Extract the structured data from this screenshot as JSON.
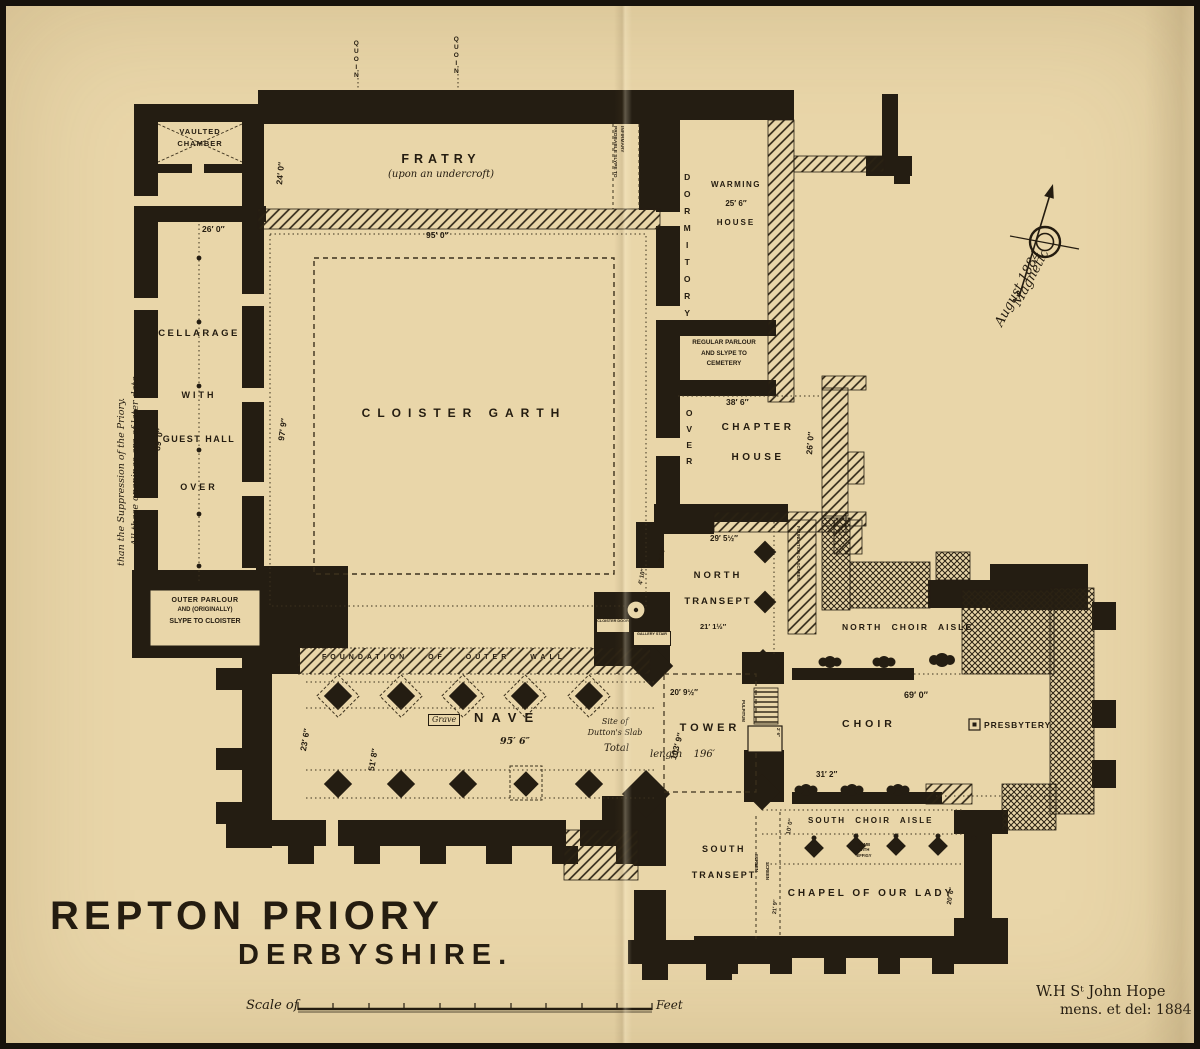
{
  "title": {
    "line1": "REPTON PRIORY",
    "line2": "DERBYSHIRE."
  },
  "scale_bar": {
    "prefix": "Scale of",
    "suffix": "Feet"
  },
  "attribution": {
    "line1": "W.H Sᵗ John Hope",
    "line2": "mens. et del: 1884"
  },
  "compass": {
    "line1": "Magnetic",
    "line2": "August 1884"
  },
  "colors": {
    "paper": "#e9d6a9",
    "ink": "#241c10",
    "wall": "#241d12"
  },
  "rooms": {
    "vaulted_chamber": {
      "line1": "VAULTED",
      "line2": "CHAMBER"
    },
    "cellarage": {
      "word1": "CELLARAGE",
      "word2": "WITH",
      "word3": "GUEST HALL",
      "word4": "OVER"
    },
    "outer_parlour": {
      "line1": "OUTER PARLOUR",
      "line2": "AND (ORIGINALLY)",
      "line3": "SLYPE TO CLOISTER"
    },
    "fratry": {
      "name": "FRATRY",
      "sub": "(upon an undercroft)"
    },
    "probable_slype": {
      "line1": "PROBABLE SLYPE TO",
      "line2": "INFIRMARY"
    },
    "dormitory": {
      "name": "DORMITORY",
      "over": "OVER"
    },
    "warming_house": {
      "line1": "WARMING",
      "line2": "HOUSE"
    },
    "regular_parlour": {
      "line1": "REGULAR PARLOUR",
      "line2": "AND SLYPE TO",
      "line3": "CEMETERY"
    },
    "chapter_house": {
      "line1": "CHAPTER",
      "line2": "HOUSE"
    },
    "cloister_garth": {
      "name": "CLOISTER GARTH"
    },
    "north_transept": {
      "line1": "NORTH",
      "line2": "TRANSEPT"
    },
    "north_choir_aisle": {
      "name": "NORTH CHOIR AISLE"
    },
    "nave": {
      "name": "NAVE"
    },
    "tower": {
      "name": "TOWER"
    },
    "choir": {
      "name": "CHOIR"
    },
    "presbytery": {
      "name": "PRESBYTERY"
    },
    "south_choir_aisle": {
      "name": "SOUTH CHOIR AISLE"
    },
    "south_transept": {
      "line1": "SOUTH",
      "line2": "TRANSEPT"
    },
    "chapel_of_our_lady": {
      "name": "CHAPEL OF OUR LADY"
    }
  },
  "annotations": {
    "later_openings": {
      "line1": "All these openings are of later date",
      "line2": "than the Suppression of the Priory."
    },
    "quoin": "QUOIN",
    "foundation_outer_wall": "FOUNDATION OF OUTER WALL",
    "foundation_screen": "FOUNDATION OF SCREEN",
    "cloister_door": "CLOISTER DOOR",
    "gallery_stair": "GALLERY STAIR",
    "grave": "Grave",
    "site_of_slab": {
      "line1": "Site of",
      "line2": "Dutton's Slab"
    },
    "total_length": {
      "word1": "Total",
      "word2": "length",
      "value": "196′"
    },
    "tomb": {
      "line1": "TOMB",
      "line2": "WITH",
      "line3": "EFFIGY"
    },
    "screen": "SCREEN",
    "pulpitum": "PULPITUM"
  },
  "dims": {
    "fratry_width": "24′ 0″",
    "fratry_length": "95′ 0″",
    "cellarage_width": "26′ 0″",
    "cellarage_length": "89′ 0″",
    "cloister_walk": "97′ 9″",
    "warming_house": "25′ 6″",
    "chapter_length": "38′ 6″",
    "chapter_width": "26′ 0″",
    "north_transept_width": "29′ 5½″",
    "north_transept_length": "21′ 1½″",
    "door_a": "3′ 10″",
    "door_b": "4′ 10″",
    "nave_length": "95′ 6″",
    "nave_width": "23′ 6″",
    "nave_aisle": "51′ 8″",
    "tower_width": "20′ 9½″",
    "axis_length": "103′ 9″",
    "choir_length": "69′ 0″",
    "choir_width": "31′ 2″",
    "south_aisle_width": "10′ 0″",
    "south_transept_dim": "21′ 9″",
    "chapel_width": "20′ 6″",
    "pulpitum_width": "2′ 6″"
  }
}
